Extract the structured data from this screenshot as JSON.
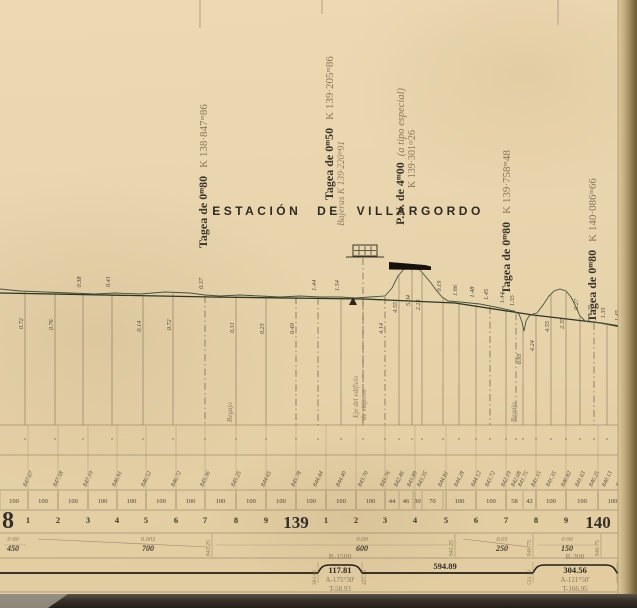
{
  "colors": {
    "ink": "#3a352a",
    "faded": "#86795a",
    "sepia": "#8d7f60",
    "tiny": "#4c4636",
    "terrain": "#46543e",
    "grade": "#2e3626",
    "band_line": "#8a7c5c",
    "ordinate": "#5c5340",
    "black": "#15120c",
    "bottom1": "#5a5348",
    "bottom2": "#241f18",
    "edge1": "#dcc89c",
    "edge2": "#c0ac7c",
    "edge3": "#937f52",
    "edge4": "#6b5c38",
    "corner": "#a09a8c"
  },
  "station": {
    "title": "ESTACIÓN DE VILLARGORDO",
    "axis_line1": "Eje del edificio",
    "axis_line2": "de viajeros"
  },
  "structures": [
    {
      "x": 207,
      "bottom": 248,
      "name": "Tagea de 0ᵐ80",
      "pk": "K 138·847ᵐ86"
    },
    {
      "x": 333,
      "bottom": 200,
      "name": "Tagea de 0ᵐ50",
      "pk": "K 139·205ᵐ86",
      "note": "Bajeras",
      "note_pk": "K 139·220ᵐ91",
      "note_x": 344,
      "note_bottom": 226
    },
    {
      "x": 404,
      "bottom": 225,
      "name": "P.N. de 4ᵐ00",
      "inline_note": "(a tipo especial)",
      "pk2": "K 139·301ᵐ26",
      "pk2_x": 415,
      "pk2_bottom": 188
    },
    {
      "x": 510,
      "bottom": 294,
      "name": "Tagea de 0ᵐ80",
      "pk": "K 139·758ᵐ48"
    },
    {
      "x": 596,
      "bottom": 322,
      "name": "Tagea de 0ᵐ80",
      "pk": "K 140·086ᵐ66"
    }
  ],
  "fold_marks": [
    {
      "x": 200,
      "y2": 28
    },
    {
      "x": 322,
      "y2": 14
    },
    {
      "x": 558,
      "y2": 25
    }
  ],
  "profile": {
    "grade": [
      [
        0,
        293
      ],
      [
        212,
        297
      ],
      [
        363,
        299
      ],
      [
        455,
        303
      ],
      [
        533,
        315
      ],
      [
        601,
        323
      ],
      [
        637,
        329
      ]
    ],
    "terrain": [
      [
        0,
        289
      ],
      [
        20,
        291
      ],
      [
        45,
        292
      ],
      [
        70,
        293
      ],
      [
        95,
        294
      ],
      [
        115,
        293
      ],
      [
        140,
        294
      ],
      [
        165,
        292
      ],
      [
        190,
        293
      ],
      [
        205,
        295
      ],
      [
        220,
        296
      ],
      [
        240,
        295
      ],
      [
        260,
        296
      ],
      [
        280,
        297
      ],
      [
        300,
        296
      ],
      [
        320,
        297
      ],
      [
        340,
        297
      ],
      [
        355,
        298
      ],
      [
        370,
        297
      ],
      [
        385,
        296
      ],
      [
        392,
        288
      ],
      [
        398,
        276
      ],
      [
        404,
        269
      ],
      [
        412,
        268
      ],
      [
        420,
        270
      ],
      [
        426,
        277
      ],
      [
        431,
        283
      ],
      [
        436,
        290
      ],
      [
        442,
        297
      ],
      [
        448,
        301
      ],
      [
        460,
        302
      ],
      [
        470,
        303
      ],
      [
        480,
        304
      ],
      [
        490,
        306
      ],
      [
        500,
        308
      ],
      [
        514,
        311
      ],
      [
        519,
        314
      ],
      [
        522,
        322
      ],
      [
        524,
        331
      ],
      [
        526,
        321
      ],
      [
        529,
        316
      ],
      [
        533,
        314
      ],
      [
        537,
        313
      ],
      [
        543,
        305
      ],
      [
        549,
        296
      ],
      [
        554,
        291
      ],
      [
        560,
        289
      ],
      [
        566,
        291
      ],
      [
        571,
        297
      ],
      [
        576,
        307
      ],
      [
        580,
        316
      ],
      [
        585,
        321
      ],
      [
        595,
        322
      ],
      [
        605,
        324
      ],
      [
        615,
        326
      ],
      [
        625,
        328
      ],
      [
        637,
        330
      ]
    ],
    "bar": [
      [
        389,
        262
      ],
      [
        425,
        265
      ],
      [
        431,
        266.5
      ],
      [
        431,
        270
      ],
      [
        389,
        269.5
      ]
    ],
    "benchmark": [
      [
        349,
        305
      ],
      [
        357,
        305
      ],
      [
        353,
        297
      ]
    ]
  },
  "building": {
    "x": 353,
    "y": 245,
    "w": 24,
    "h": 11,
    "base_x1": 346,
    "base_x2": 384,
    "axis_x": 363
  },
  "ordinates": [
    {
      "x": 25,
      "v": "0.72",
      "p": "b"
    },
    {
      "x": 55,
      "v": "0.76",
      "p": "b"
    },
    {
      "x": 83,
      "v": "0.38",
      "p": "a"
    },
    {
      "x": 112,
      "v": "0.41",
      "p": "a"
    },
    {
      "x": 143,
      "v": "0.14",
      "p": "b"
    },
    {
      "x": 173,
      "v": "0.72",
      "p": "b"
    },
    {
      "x": 205,
      "v": "0.37",
      "p": "a",
      "d": 1
    },
    {
      "x": 236,
      "v": "0.31",
      "p": "b"
    },
    {
      "x": 266,
      "v": "0.25",
      "p": "b"
    },
    {
      "x": 296,
      "v": "0.40",
      "p": "b",
      "d": 1
    },
    {
      "x": 318,
      "v": "1.44",
      "p": "a",
      "d": 1
    },
    {
      "x": 341,
      "v": "1.54",
      "p": "a"
    },
    {
      "x": 363,
      "v": "",
      "p": "a",
      "d": 1
    },
    {
      "x": 385,
      "v": "4.14",
      "p": "b",
      "d": 1
    },
    {
      "x": 399,
      "v": "4.55",
      "p": "b"
    },
    {
      "x": 412,
      "v": "5.04",
      "p": "b"
    },
    {
      "x": 422,
      "v": "2.25",
      "p": "b"
    },
    {
      "x": 443,
      "v": "0.19",
      "p": "a"
    },
    {
      "x": 459,
      "v": "1.66",
      "p": "a"
    },
    {
      "x": 476,
      "v": "1.48",
      "p": "a"
    },
    {
      "x": 490,
      "v": "1.45",
      "p": "a",
      "d": 1
    },
    {
      "x": 506,
      "v": "1.44",
      "p": "a"
    },
    {
      "x": 516,
      "v": "1.35",
      "p": "a",
      "d": 1
    },
    {
      "x": 523,
      "v": "0.95",
      "p": "b"
    },
    {
      "x": 536,
      "v": "4.24",
      "p": "b"
    },
    {
      "x": 551,
      "v": "4.55",
      "p": "b"
    },
    {
      "x": 566,
      "v": "2.35",
      "p": "b"
    },
    {
      "x": 580,
      "v": "0.27",
      "p": "a"
    },
    {
      "x": 594,
      "v": "1.25",
      "p": "a",
      "d": 1
    },
    {
      "x": 607,
      "v": "1.35",
      "p": "a"
    },
    {
      "x": 621,
      "v": "1.45",
      "p": "a",
      "d": 1
    },
    {
      "x": 632,
      "v": "1.36",
      "p": "b"
    }
  ],
  "bands": {
    "lines": [
      425,
      455,
      490,
      510,
      533,
      558,
      592
    ],
    "hecto_ticks": [
      28,
      58,
      88,
      117,
      146,
      176,
      205,
      236,
      266,
      296,
      326,
      356,
      385,
      415,
      446,
      476,
      506,
      536,
      566,
      598,
      627
    ],
    "hectometers": [
      {
        "x": 28,
        "v": "1"
      },
      {
        "x": 58,
        "v": "2"
      },
      {
        "x": 88,
        "v": "3"
      },
      {
        "x": 117,
        "v": "4"
      },
      {
        "x": 146,
        "v": "5"
      },
      {
        "x": 176,
        "v": "6"
      },
      {
        "x": 205,
        "v": "7"
      },
      {
        "x": 236,
        "v": "8"
      },
      {
        "x": 266,
        "v": "9"
      },
      {
        "x": 326,
        "v": "1"
      },
      {
        "x": 356,
        "v": "2"
      },
      {
        "x": 385,
        "v": "3"
      },
      {
        "x": 415,
        "v": "4"
      },
      {
        "x": 446,
        "v": "5"
      },
      {
        "x": 476,
        "v": "6"
      },
      {
        "x": 506,
        "v": "7"
      },
      {
        "x": 536,
        "v": "8"
      },
      {
        "x": 566,
        "v": "9"
      },
      {
        "x": 627,
        "v": "1"
      }
    ],
    "kilometers": [
      {
        "x": 2,
        "v": "8",
        "fs": 24,
        "anchor": "start"
      },
      {
        "x": 296,
        "v": "139",
        "fs": 17,
        "anchor": "middle"
      },
      {
        "x": 598,
        "v": "140",
        "fs": 17,
        "anchor": "middle"
      }
    ],
    "distances": [
      {
        "x1": 0,
        "x2": 28,
        "v": "100"
      },
      {
        "x1": 28,
        "x2": 58,
        "v": "100"
      },
      {
        "x1": 58,
        "x2": 88,
        "v": "100"
      },
      {
        "x1": 88,
        "x2": 117,
        "v": "100"
      },
      {
        "x1": 117,
        "x2": 146,
        "v": "100"
      },
      {
        "x1": 146,
        "x2": 176,
        "v": "100"
      },
      {
        "x1": 176,
        "x2": 205,
        "v": "100"
      },
      {
        "x1": 205,
        "x2": 236,
        "v": "100"
      },
      {
        "x1": 236,
        "x2": 266,
        "v": "100"
      },
      {
        "x1": 266,
        "x2": 296,
        "v": "100"
      },
      {
        "x1": 296,
        "x2": 326,
        "v": "100"
      },
      {
        "x1": 326,
        "x2": 356,
        "v": "100"
      },
      {
        "x1": 356,
        "x2": 385,
        "v": "100"
      },
      {
        "x1": 385,
        "x2": 399,
        "v": "44"
      },
      {
        "x1": 399,
        "x2": 413,
        "v": "46"
      },
      {
        "x1": 413,
        "x2": 422,
        "v": "30"
      },
      {
        "x1": 422,
        "x2": 443,
        "v": "70"
      },
      {
        "x1": 443,
        "x2": 476,
        "v": "100"
      },
      {
        "x1": 476,
        "x2": 506,
        "v": "100"
      },
      {
        "x1": 506,
        "x2": 523,
        "v": "58"
      },
      {
        "x1": 523,
        "x2": 536,
        "v": "42"
      },
      {
        "x1": 536,
        "x2": 566,
        "v": "100"
      },
      {
        "x1": 566,
        "x2": 598,
        "v": "100"
      },
      {
        "x1": 598,
        "x2": 627,
        "v": "100"
      },
      {
        "x1": 627,
        "x2": 637,
        "v": "30"
      }
    ],
    "elevations": [
      {
        "x": 28,
        "v": "847.07"
      },
      {
        "x": 58,
        "v": "847.58"
      },
      {
        "x": 88,
        "v": "847.19"
      },
      {
        "x": 117,
        "v": "846.91"
      },
      {
        "x": 146,
        "v": "846.52"
      },
      {
        "x": 176,
        "v": "846.72"
      },
      {
        "x": 205,
        "v": "845.36"
      },
      {
        "x": 236,
        "v": "845.25"
      },
      {
        "x": 266,
        "v": "844.65"
      },
      {
        "x": 296,
        "v": "845.78"
      },
      {
        "x": 318,
        "v": "844.44"
      },
      {
        "x": 341,
        "v": "844.40"
      },
      {
        "x": 363,
        "v": "843.70"
      },
      {
        "x": 385,
        "v": "843.76"
      },
      {
        "x": 399,
        "v": "842.46"
      },
      {
        "x": 412,
        "v": "843.89"
      },
      {
        "x": 422,
        "v": "843.35"
      },
      {
        "x": 443,
        "v": "844.81"
      },
      {
        "x": 459,
        "v": "844.28"
      },
      {
        "x": 476,
        "v": "844.12"
      },
      {
        "x": 490,
        "v": "843.72"
      },
      {
        "x": 506,
        "v": "842.19"
      },
      {
        "x": 516,
        "v": "842.08"
      },
      {
        "x": 523,
        "v": "841.75"
      },
      {
        "x": 536,
        "v": "841.15"
      },
      {
        "x": 551,
        "v": "841.35"
      },
      {
        "x": 566,
        "v": "840.82"
      },
      {
        "x": 580,
        "v": "841.63"
      },
      {
        "x": 594,
        "v": "840.25"
      },
      {
        "x": 607,
        "v": "840.13"
      },
      {
        "x": 621,
        "v": "839.82"
      },
      {
        "x": 632,
        "v": "839.63"
      }
    ],
    "regajo_label": "Regajo",
    "regajos": [
      {
        "x": 233
      },
      {
        "x": 517
      },
      {
        "x": 630
      }
    ]
  },
  "gradients": {
    "segments": [
      {
        "x1": 0,
        "x2": 30,
        "top": "0 00",
        "bottom": "450",
        "lx": 13,
        "slope": 0
      },
      {
        "x1": 30,
        "x2": 212,
        "top": "0.003",
        "bottom": "700",
        "lx": 148,
        "slope": 1
      },
      {
        "x1": 212,
        "x2": 455,
        "top": "0.00",
        "bottom": "600",
        "lx": 362,
        "slope": 0
      },
      {
        "x1": 455,
        "x2": 533,
        "top": "0.01",
        "bottom": "250",
        "lx": 502,
        "slope": 1
      },
      {
        "x1": 533,
        "x2": 601,
        "top": "0 00",
        "bottom": "150",
        "lx": 567,
        "slope": 0
      }
    ],
    "breaks": [
      {
        "x": 212,
        "v": "843.25"
      },
      {
        "x": 455,
        "v": "843.25"
      },
      {
        "x": 533,
        "v": "840.75"
      },
      {
        "x": 601,
        "v": "840.75"
      },
      {
        "x": 631,
        "v": "840.75"
      }
    ]
  },
  "alignment": {
    "base_y": 573,
    "plateau_y": 565,
    "segments": [
      {
        "type": "line",
        "x1": 0,
        "x2": 318
      },
      {
        "type": "hump",
        "x1": 318,
        "x2": 362,
        "r": "R-1500",
        "len": "117.81",
        "a": "A-175°30'",
        "t": "T-58.93",
        "pk_l": "303.62",
        "pk_r": "421.43"
      },
      {
        "type": "line",
        "x1": 362,
        "x2": 533,
        "label": "594.89",
        "lx": 445
      },
      {
        "type": "hump",
        "x1": 533,
        "x2": 617,
        "r": "R-300",
        "len": "304.56",
        "a": "A-121°50'",
        "t": "T-166.95",
        "pk_l": "533.12",
        "pk_r": "617.68"
      },
      {
        "type": "line",
        "x1": 617,
        "x2": 637,
        "label": "104",
        "lx": 629
      }
    ]
  }
}
